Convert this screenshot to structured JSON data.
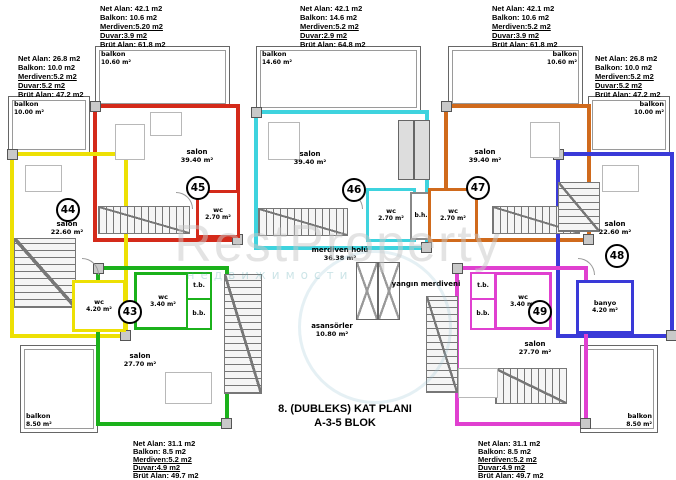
{
  "watermark": {
    "brand": "RestProperty",
    "sub": "недвижимости"
  },
  "title": {
    "line1": "8. (DUBLEKS) KAT  PLANI",
    "line2": "A-3-5 BLOK"
  },
  "info_blocks": {
    "top_left": {
      "net": "Net Alan: 42.1 m2",
      "balkon": "Balkon: 10.6 m2",
      "merdiven": "Merdiven:5.20 m2",
      "duvar": "Duvar:3.9 m2",
      "brut": "Brüt Alan: 61.8 m2"
    },
    "top_center": {
      "net": "Net Alan: 42.1 m2",
      "balkon": "Balkon: 14.6 m2",
      "merdiven": "Merdiven:5.2 m2",
      "duvar": "Duvar:2.9 m2",
      "brut": "Brüt Alan: 64.8 m2"
    },
    "top_right": {
      "net": "Net Alan: 42.1 m2",
      "balkon": "Balkon: 10.6 m2",
      "merdiven": "Merdiven:5.2 m2",
      "duvar": "Duvar:3.9 m2",
      "brut": "Brüt Alan: 61.8 m2"
    },
    "left": {
      "net": "Net Alan: 26.8 m2",
      "balkon": "Balkon: 10.0 m2",
      "merdiven": "Merdiven:5.2 m2",
      "duvar": "Duvar:5.2 m2",
      "brut": "Brüt Alan: 47.2 m2"
    },
    "right": {
      "net": "Net Alan: 26.8 m2",
      "balkon": "Balkon: 10.0 m2",
      "merdiven": "Merdiven:5.2 m2",
      "duvar": "Duvar:5.2 m2",
      "brut": "Brüt Alan: 47.2 m2"
    },
    "bottom_left": {
      "net": "Net Alan: 31.1 m2",
      "balkon": "Balkon: 8.5 m2",
      "merdiven": "Merdiven:5.2 m2",
      "duvar": "Duvar:4.9 m2",
      "brut": "Brüt Alan: 49.7 m2"
    },
    "bottom_right": {
      "net": "Net Alan: 31.1 m2",
      "balkon": "Balkon: 8.5 m2",
      "merdiven": "Merdiven:5.2 m2",
      "duvar": "Duvar:4.9 m2",
      "brut": "Brüt Alan: 49.7 m2"
    }
  },
  "units": {
    "u43": {
      "number": "43",
      "color": "#1bb11b",
      "salon": {
        "name": "salon",
        "area": "27.70 m²"
      },
      "wc": {
        "name": "wc",
        "area": "3.40 m²"
      },
      "tb": "t.b.",
      "bb": "b.b.",
      "balkon": {
        "name": "balkon",
        "area": "8.50 m²"
      }
    },
    "u44": {
      "number": "44",
      "color": "#ede004",
      "salon": {
        "name": "salon",
        "area": "22.60 m²"
      },
      "wc": {
        "name": "wc",
        "area": "4.20 m²"
      },
      "balkon": {
        "name": "balkon",
        "area": "10.00 m²"
      }
    },
    "u45": {
      "number": "45",
      "color": "#d42a1a",
      "salon": {
        "name": "salon",
        "area": "39.40 m²"
      },
      "wc": {
        "name": "wc",
        "area": "2.70 m²"
      },
      "balkon": {
        "name": "balkon",
        "area": "10.60 m²"
      }
    },
    "u46": {
      "number": "46",
      "color": "#3ed3de",
      "salon": {
        "name": "salon",
        "area": "39.40 m²"
      },
      "wc": {
        "name": "wc",
        "area": "2.70 m²"
      },
      "balkon": {
        "name": "balkon",
        "area": "14.60 m²"
      }
    },
    "u47": {
      "number": "47",
      "color": "#d06a1c",
      "salon": {
        "name": "salon",
        "area": "39.40 m²"
      },
      "wc": {
        "name": "wc",
        "area": "2.70 m²"
      },
      "balkon": {
        "name": "balkon",
        "area": "10.60 m²"
      }
    },
    "u48": {
      "number": "48",
      "color": "#3a3ad8",
      "salon": {
        "name": "salon",
        "area": "22.60 m²"
      },
      "banyo": {
        "name": "banyo",
        "area": "4.20 m²"
      },
      "balkon": {
        "name": "balkon",
        "area": "10.00 m²"
      }
    },
    "u49": {
      "number": "49",
      "color": "#e040d0",
      "salon": {
        "name": "salon",
        "area": "27.70 m²"
      },
      "wc": {
        "name": "wc",
        "area": "3.40 m²"
      },
      "tb": "t.b.",
      "bb": "b.b.",
      "balkon": {
        "name": "balkon",
        "area": "8.50 m²"
      }
    }
  },
  "common": {
    "merdiven_holu": {
      "name": "merdiven holü",
      "area": "36.38 m²"
    },
    "asansorler": {
      "name": "asansörler",
      "area": "10.80 m²"
    },
    "yangin_merdiveni": "yangın merdiveni",
    "bh": "b.h."
  }
}
